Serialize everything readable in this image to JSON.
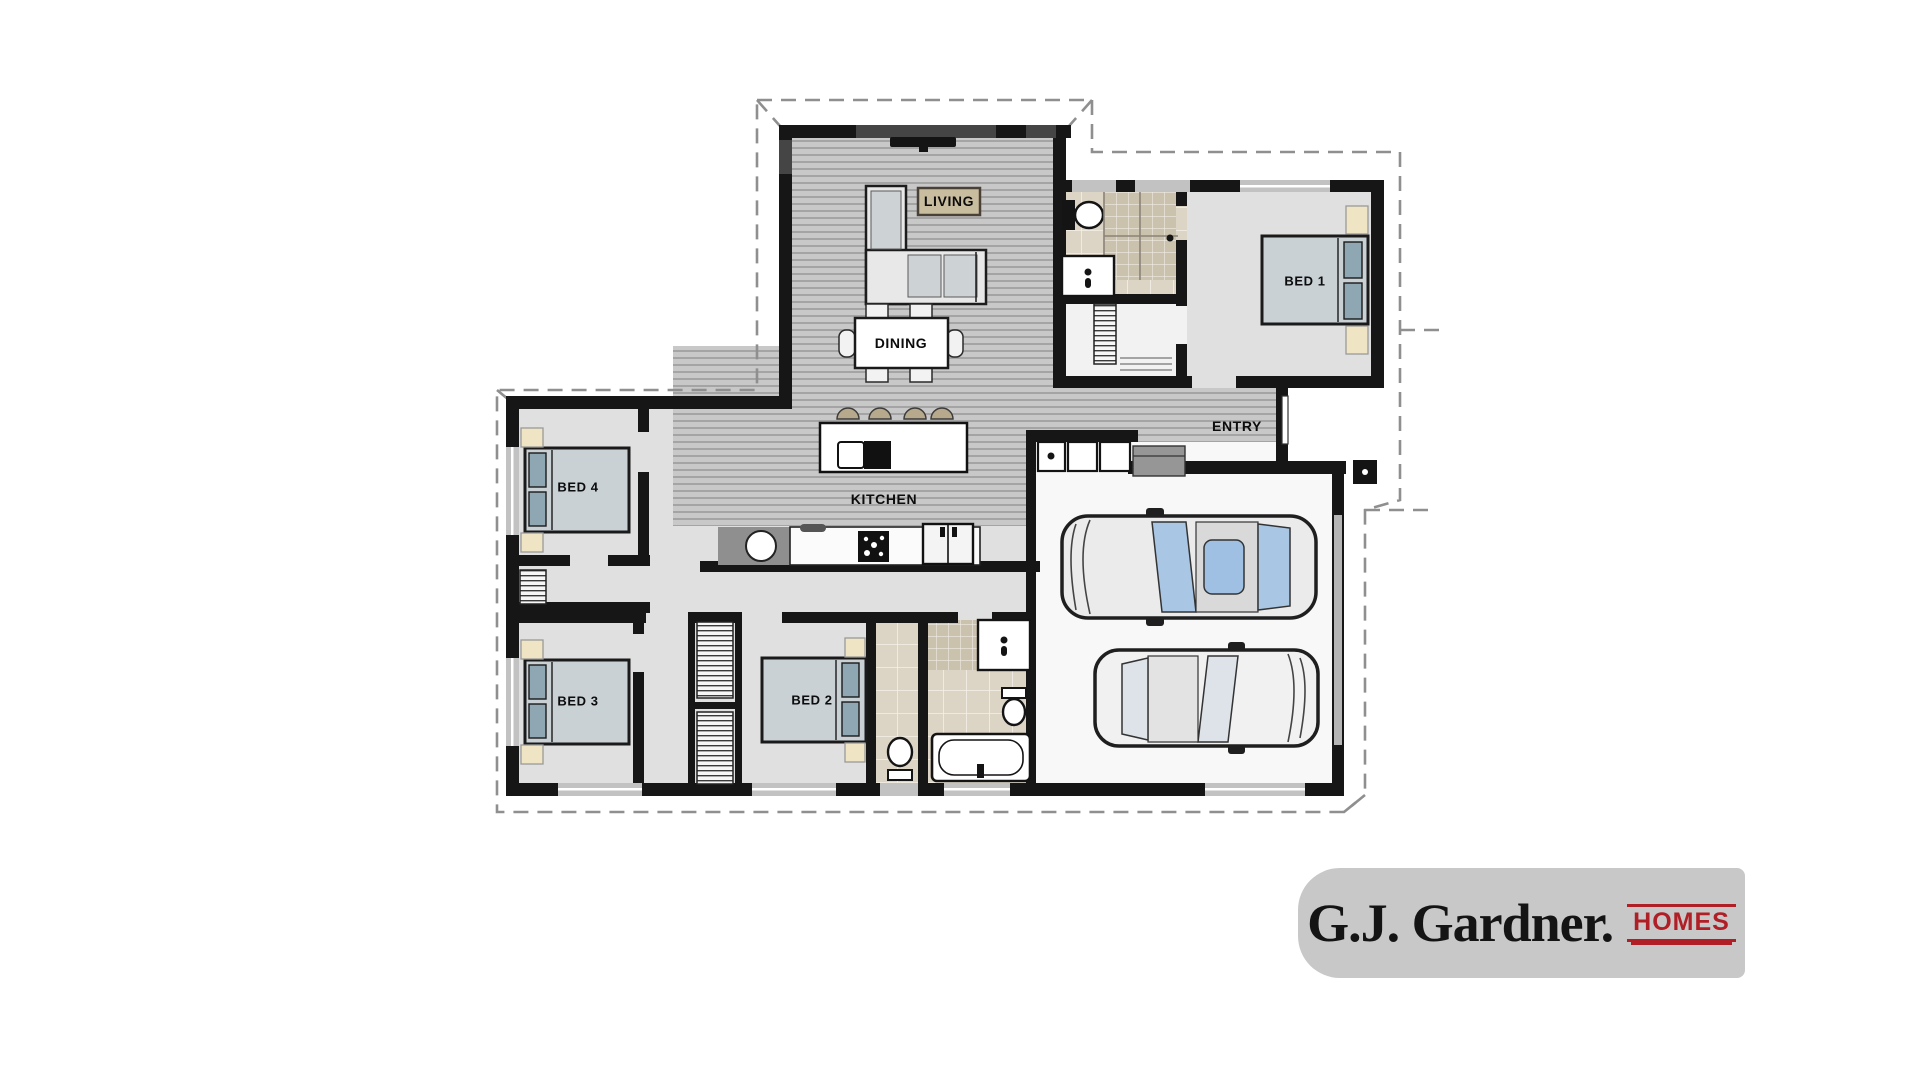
{
  "document": {
    "type": "floor-plan",
    "title": "Single storey house floor plan with double garage"
  },
  "rooms": {
    "living": {
      "label": "LIVING"
    },
    "dining": {
      "label": "DINING"
    },
    "kitchen": {
      "label": "KITCHEN"
    },
    "entry": {
      "label": "ENTRY"
    },
    "bed1": {
      "label": "BED 1"
    },
    "bed2": {
      "label": "BED 2"
    },
    "bed3": {
      "label": "BED 3"
    },
    "bed4": {
      "label": "BED 4"
    }
  },
  "logo": {
    "brand": "G.J. Gardner.",
    "suffix": "HOMES",
    "brand_color": "#141414",
    "accent_color": "#b01f26",
    "background": "#c8c8c8"
  },
  "colors": {
    "wall": "#161616",
    "wood_floor": "#c8c8c8",
    "plain_floor": "#e0e0e0",
    "tile_floor": "#dcd5c6",
    "bed_fill": "#c9d1d5",
    "pillow": "#8fa6b3",
    "bedside_table": "#efe5c4",
    "car_glass": "#a9c7e4",
    "stool": "#b7a98b",
    "dashed_outline": "#8f8f8f"
  }
}
